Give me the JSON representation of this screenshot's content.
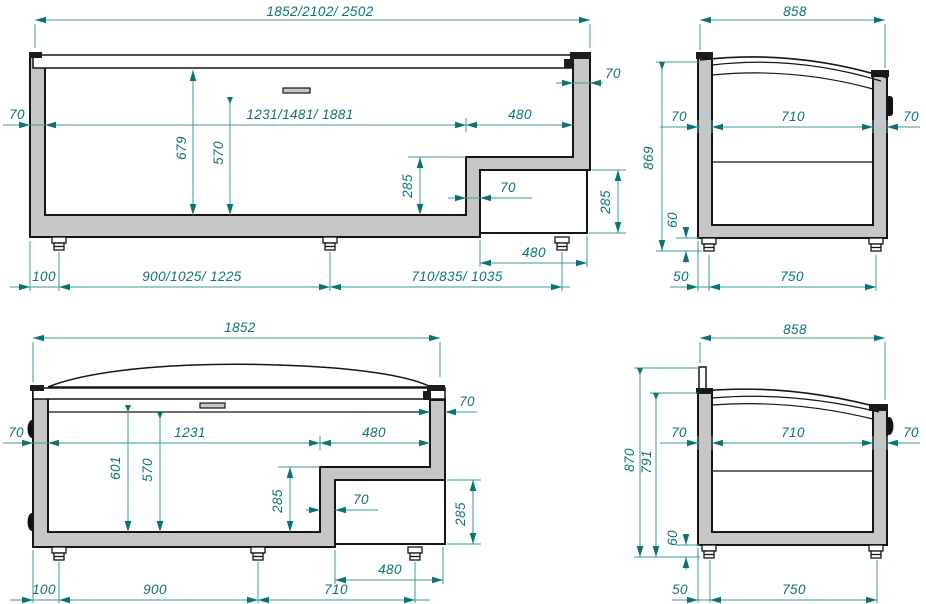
{
  "drawing": {
    "front_section": {
      "dims": {
        "total_width": "1852/2102/ 2502",
        "left_wall": "70",
        "inner_width": "1231/1481/ 1881",
        "step_top_width": "480",
        "right_wall": "70",
        "inner_height": "679",
        "load_height": "570",
        "step_height": "285",
        "step_wall": "70",
        "compartment_height": "285",
        "compartment_width": "480",
        "foot_offset": "100",
        "foot_span_left": "900/1025/ 1225",
        "foot_span_right": "710/835/ 1035"
      }
    },
    "side_section": {
      "dims": {
        "total_depth": "858",
        "total_height": "869",
        "left_wall": "70",
        "inner_depth": "710",
        "right_wall": "70",
        "leg_height": "60",
        "foot_offset": "50",
        "foot_span": "750"
      }
    },
    "front_view": {
      "dims": {
        "total_width": "1852",
        "left_wall": "70",
        "inner_width": "1231",
        "step_top_width": "480",
        "right_wall": "70",
        "inner_height": "601",
        "load_height": "570",
        "step_height": "285",
        "step_wall": "70",
        "compartment_height": "285",
        "compartment_width": "480",
        "foot_offset": "100",
        "foot_span_left": "900",
        "foot_span_right": "710"
      }
    },
    "side_view": {
      "dims": {
        "total_depth": "858",
        "overall_height": "870",
        "body_height": "791",
        "left_wall": "70",
        "inner_depth": "710",
        "right_wall": "70",
        "leg_height": "60",
        "foot_offset": "50",
        "foot_span": "750"
      }
    },
    "colors": {
      "dimension_text": "#0a7474",
      "dimension_line": "#3a9b9b",
      "body_fill": "#c6c6c6",
      "outline": "#151515"
    }
  }
}
